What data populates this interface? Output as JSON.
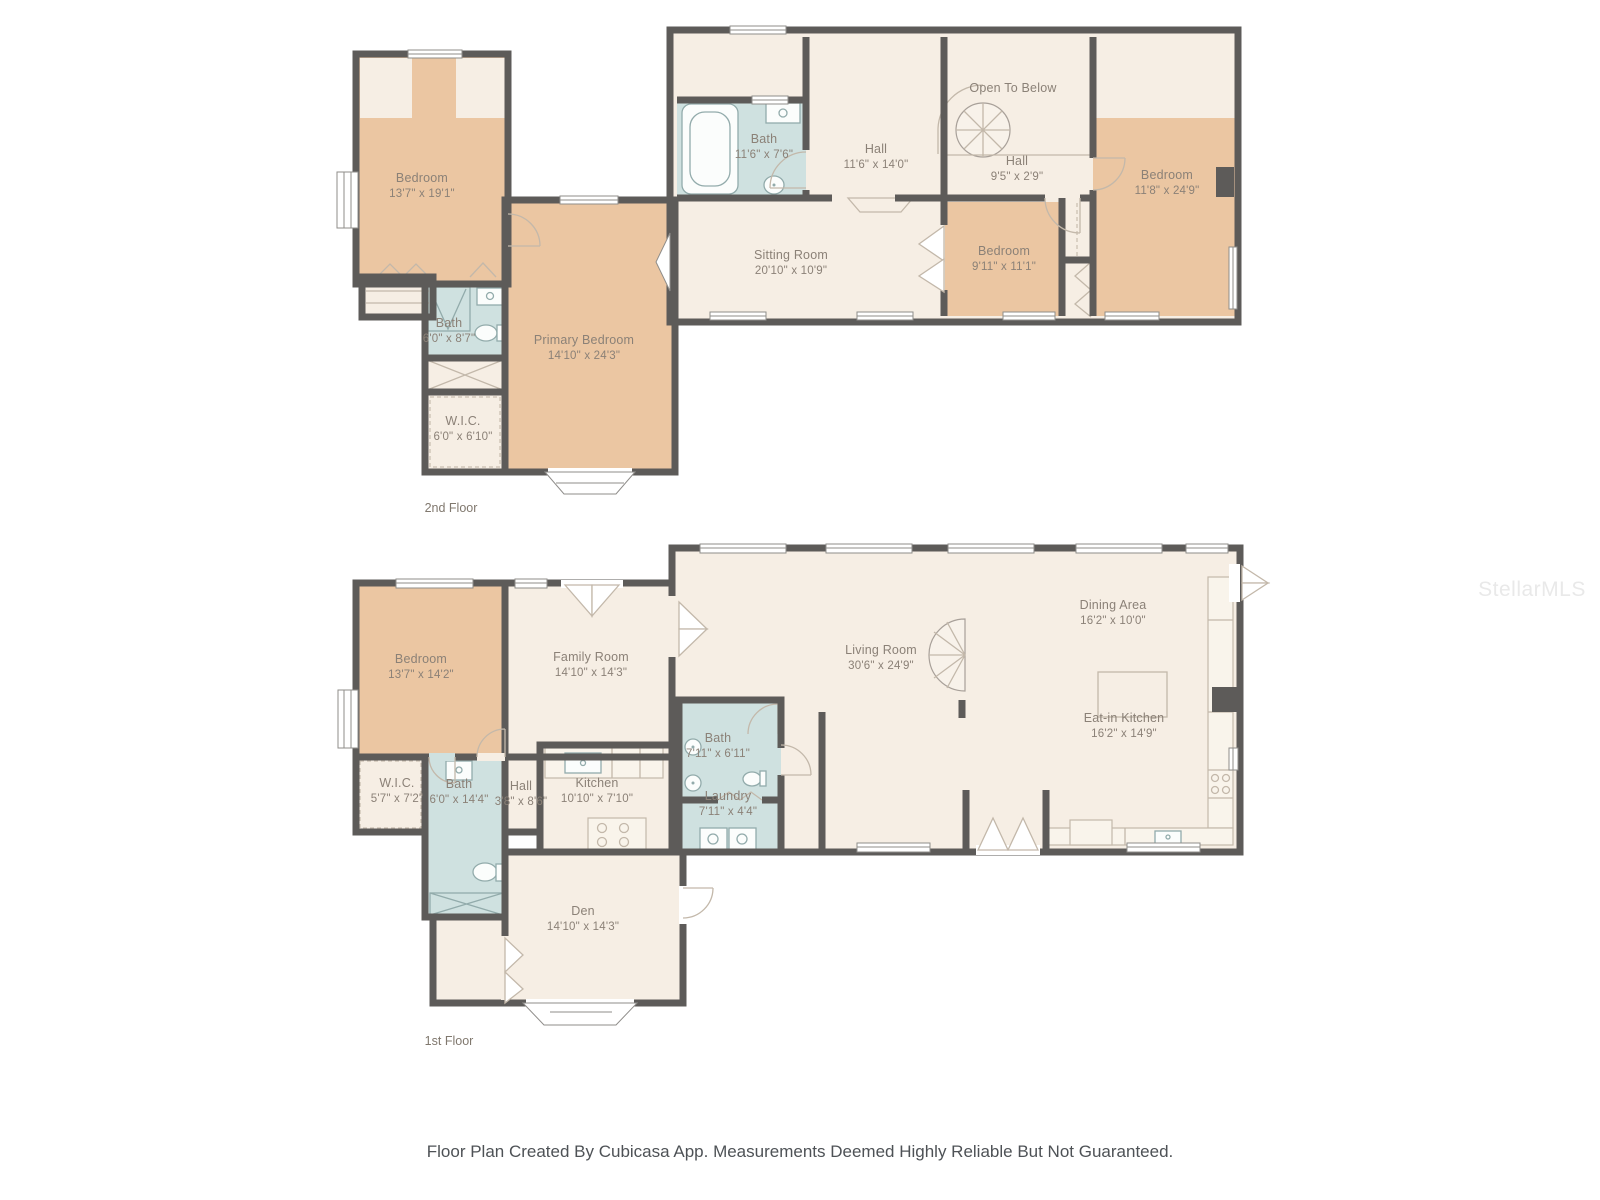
{
  "colors": {
    "wall": "#5d5b59",
    "room_fill": "#f6eee4",
    "bedroom_fill": "#ebc6a2",
    "bath_fill": "#cfe1e0",
    "label_text": "#8b8177",
    "footer_text": "#4e5256",
    "background": "#ffffff"
  },
  "floors": [
    {
      "label": "2nd Floor",
      "rooms": [
        {
          "name": "Bedroom",
          "dims": "13'7\" x 19'1\""
        },
        {
          "name": "Bath",
          "dims": "6'0\" x 8'7\""
        },
        {
          "name": "W.I.C.",
          "dims": "6'0\" x 6'10\""
        },
        {
          "name": "Primary Bedroom",
          "dims": "14'10\" x 24'3\""
        },
        {
          "name": "Bath",
          "dims": "11'6\" x 7'6\""
        },
        {
          "name": "Hall",
          "dims": "11'6\" x 14'0\""
        },
        {
          "name": "Open To Below",
          "dims": ""
        },
        {
          "name": "Hall",
          "dims": "9'5\" x 2'9\""
        },
        {
          "name": "Sitting Room",
          "dims": "20'10\" x 10'9\""
        },
        {
          "name": "Bedroom",
          "dims": "9'11\" x 11'1\""
        },
        {
          "name": "Bedroom",
          "dims": "11'8\" x 24'9\""
        }
      ]
    },
    {
      "label": "1st Floor",
      "rooms": [
        {
          "name": "Bedroom",
          "dims": "13'7\" x 14'2\""
        },
        {
          "name": "Family Room",
          "dims": "14'10\" x 14'3\""
        },
        {
          "name": "W.I.C.",
          "dims": "5'7\" x 7'2\""
        },
        {
          "name": "Bath",
          "dims": "6'0\" x 14'4\""
        },
        {
          "name": "Hall",
          "dims": "3'8\" x 8'6\""
        },
        {
          "name": "Kitchen",
          "dims": "10'10\" x 7'10\""
        },
        {
          "name": "Den",
          "dims": "14'10\" x 14'3\""
        },
        {
          "name": "Living Room",
          "dims": "30'6\" x 24'9\""
        },
        {
          "name": "Dining Area",
          "dims": "16'2\" x 10'0\""
        },
        {
          "name": "Eat-in Kitchen",
          "dims": "16'2\" x 14'9\""
        },
        {
          "name": "Bath",
          "dims": "7'11\" x 6'11\""
        },
        {
          "name": "Laundry",
          "dims": "7'11\" x 4'4\""
        }
      ]
    }
  ],
  "footer": {
    "text": "Floor Plan Created By Cubicasa App. Measurements Deemed Highly Reliable But Not Guaranteed."
  },
  "watermark": {
    "text": "StellarMLS"
  }
}
